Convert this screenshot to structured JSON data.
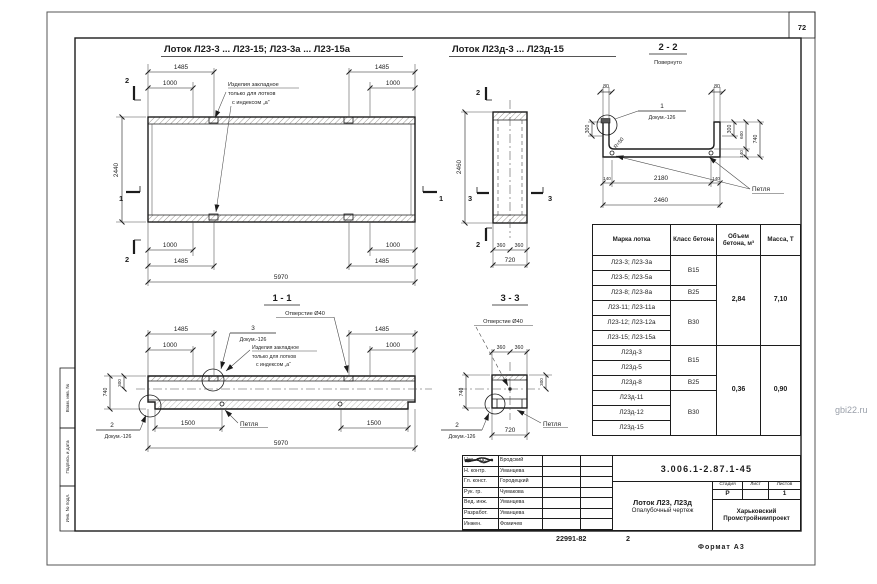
{
  "colors": {
    "ink": "#1c1c1c",
    "paper": "#ffffff",
    "watermark_color": "#9aa0aa"
  },
  "page": {
    "sheet_number": "72",
    "watermark": "gbi22.ru",
    "footer_doc": "22991-82",
    "footer_sheet": "2",
    "format_label": "Формат А3"
  },
  "titles": {
    "plan": "Лоток Л23-3 ... Л23-15; Л23-3а ... Л23-15а",
    "plan2": "Лоток Л23д-3 ... Л23д-15",
    "sec22": "2 - 2",
    "sec22_note": "Повернуто",
    "sec11": "1 - 1",
    "sec33": "3 - 3"
  },
  "labels": {
    "embed_note_l1": "Изделия закладное",
    "embed_note_l2": "только для лотков",
    "embed_note_l3": "с индексом „а“",
    "hole": "Отверстие Ø40",
    "loop": "Петля",
    "dokum": "Докум.-126",
    "radius": "R=50"
  },
  "marks": {
    "m1": "1",
    "m2": "2",
    "m3": "3"
  },
  "dims": {
    "d80": "80",
    "d140": "140",
    "d300": "300",
    "d360": "360",
    "d600": "600",
    "d720": "720",
    "d740": "740",
    "d1000": "1000",
    "d1485": "1485",
    "d1500": "1500",
    "d2180": "2180",
    "d2440": "2440",
    "d2460": "2460",
    "d5970": "5970"
  },
  "table": {
    "headers": [
      "Марка лотка",
      "Класс бетона",
      "Объем бетона, м³",
      "Масса, Т"
    ],
    "marks": [
      "Л23-3; Л23-3а",
      "Л23-5; Л23-5а",
      "Л23-8; Л23-8а",
      "Л23-11; Л23-11а",
      "Л23-12; Л23-12а",
      "Л23-15; Л23-15а",
      "Л23д-3",
      "Л23д-5",
      "Л23д-8",
      "Л23д-11",
      "Л23д-12",
      "Л23д-15"
    ],
    "class_groups": [
      {
        "value": "В15",
        "span": 2
      },
      {
        "value": "В25",
        "span": 1
      },
      {
        "value": "В30",
        "span": 3
      },
      {
        "value": "В15",
        "span": 2
      },
      {
        "value": "В25",
        "span": 1
      },
      {
        "value": "В30",
        "span": 3
      }
    ],
    "volume_groups": [
      {
        "value": "2,84",
        "span": 6
      },
      {
        "value": "0,36",
        "span": 6
      }
    ],
    "mass_groups": [
      {
        "value": "7,10",
        "span": 6
      },
      {
        "value": "0,90",
        "span": 6
      }
    ]
  },
  "titleblock": {
    "doc_number": "3.006.1-2.87.1-45",
    "title_line1": "Лоток Л23, Л23д",
    "title_line2": "Опалубочный чертеж",
    "stage_label": "Стадия",
    "sheet_label": "Лист",
    "sheets_label": "Листов",
    "stage_value": "Р",
    "sheet_value": "",
    "sheets_value": "1",
    "org_line1": "Харьковский",
    "org_line2": "Промстройниипроект",
    "staff": [
      {
        "role": "Нач. отд.",
        "name": "Бродский"
      },
      {
        "role": "Н. контр.",
        "name": "Уманцева"
      },
      {
        "role": "Гл. конст.",
        "name": "Городецкий"
      },
      {
        "role": "Рук. гр.",
        "name": "Чумакова"
      },
      {
        "role": "Вед. инж.",
        "name": "Уманцева"
      },
      {
        "role": "Разработ.",
        "name": "Уманцева"
      },
      {
        "role": "Инжен.",
        "name": "Фомичев"
      }
    ]
  },
  "margin": {
    "labels": [
      "Взам. инв. №",
      "Подпись и дата",
      "Инв. № подл."
    ]
  }
}
